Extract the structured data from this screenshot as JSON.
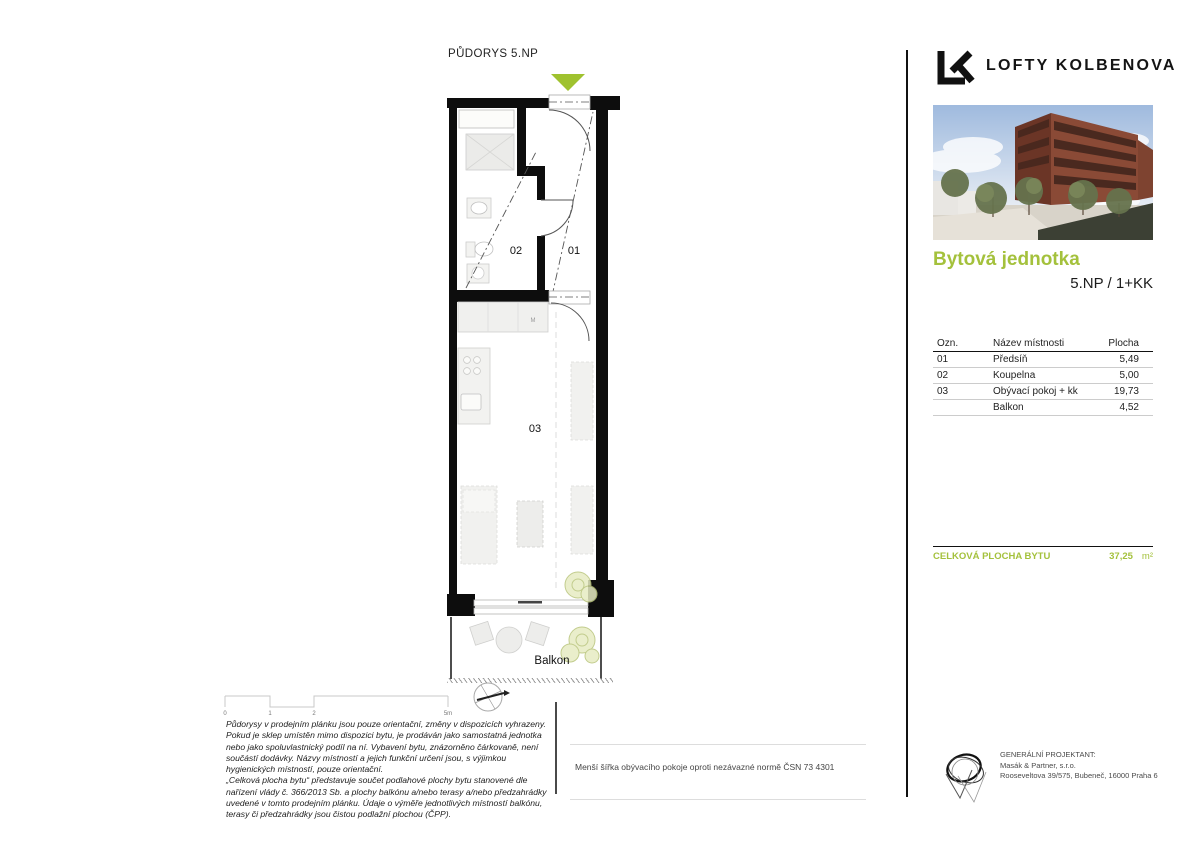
{
  "plan": {
    "title": "PŮDORYS 5.NP",
    "labels": {
      "room01": "01",
      "room02": "02",
      "room03": "03",
      "balkon": "Balkon",
      "kitchen": "M"
    },
    "scale_ticks": [
      "0",
      "1",
      "2",
      "5m"
    ]
  },
  "brand": {
    "logo": "LK",
    "name": "LOFTY KOLBENOVA"
  },
  "unit": {
    "heading": "Bytová jednotka",
    "subheading": "5.NP / 1+KK"
  },
  "rooms_table": {
    "headers": [
      "Ozn.",
      "Název místnosti",
      "Plocha"
    ],
    "rows": [
      {
        "ozn": "01",
        "name": "Předsíň",
        "area": "5,49"
      },
      {
        "ozn": "02",
        "name": "Koupelna",
        "area": "5,00"
      },
      {
        "ozn": "03",
        "name": "Obývací pokoj + kk",
        "area": "19,73"
      },
      {
        "ozn": "",
        "name": "Balkon",
        "area": "4,52"
      }
    ]
  },
  "total": {
    "label": "CELKOVÁ PLOCHA BYTU",
    "value": "37,25",
    "unit": "m²"
  },
  "footer": {
    "disclaimer_p1": "Půdorysy v prodejním plánku jsou pouze orientační, změny v dispozicích vyhrazeny. Pokud je sklep umístěn mimo dispozici bytu, je prodáván jako samostatná jednotka nebo jako spoluvlastnický podíl na ní. Vybavení bytu, znázorněno čárkovaně, není součástí dodávky. Názvy místností a jejich funkční určení jsou, s výjimkou hygienických místností, pouze orientační.",
    "disclaimer_p2": "„Celková plocha bytu“ představuje součet podlahové plochy bytu stanovené dle nařízení vlády č. 366/2013 Sb. a plochy balkónu a/nebo terasy a/nebo předzahrádky uvedené v tomto prodejním plánku. Údaje o výměře jednotlivých místností balkónu, terasy či předzahrádky jsou čistou podlažní plochou (ČPP).",
    "note": "Menší šířka obývacího pokoje oproti nezávazné normě ČSN 73 4301",
    "projektant": {
      "label": "GENERÁLNÍ PROJEKTANT:",
      "company": "Masák & Partner, s.r.o.",
      "address": "Rooseveltova 39/575, Bubeneč, 16000 Praha 6"
    }
  },
  "colors": {
    "accent_green": "#a4c13c",
    "entrance_marker_green": "#9fc22f",
    "wall_black": "#0d0d0d"
  }
}
